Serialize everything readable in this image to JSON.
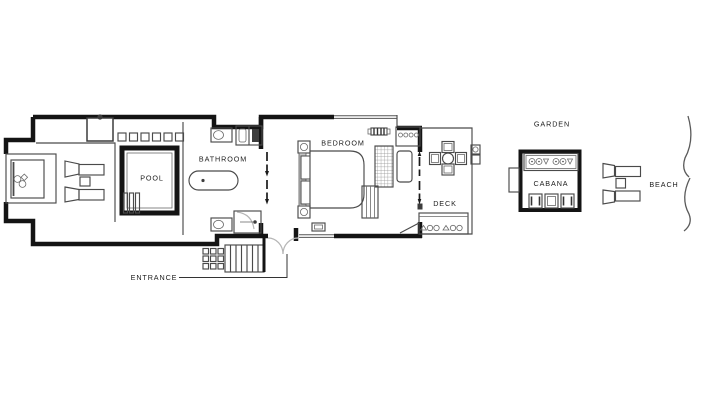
{
  "figure": {
    "type": "floor-plan",
    "description": "Beachfront villa floor plan with pool terrace, bathroom, bedroom, deck, garden cabana and beach"
  },
  "labels": {
    "pool": "POOL",
    "bathroom": "BATHROOM",
    "bedroom": "BEDROOM",
    "deck": "DECK",
    "garden": "GARDEN",
    "cabana": "CABANA",
    "beach": "BEACH",
    "entrance": "ENTRANCE"
  },
  "colors": {
    "background": "#ffffff",
    "wall": "#141414",
    "furniture_line": "#4a4a4a",
    "door_swing": "#b5b5b5",
    "headboard_fill": "#c4c4c4",
    "text": "#1c1c1c"
  }
}
